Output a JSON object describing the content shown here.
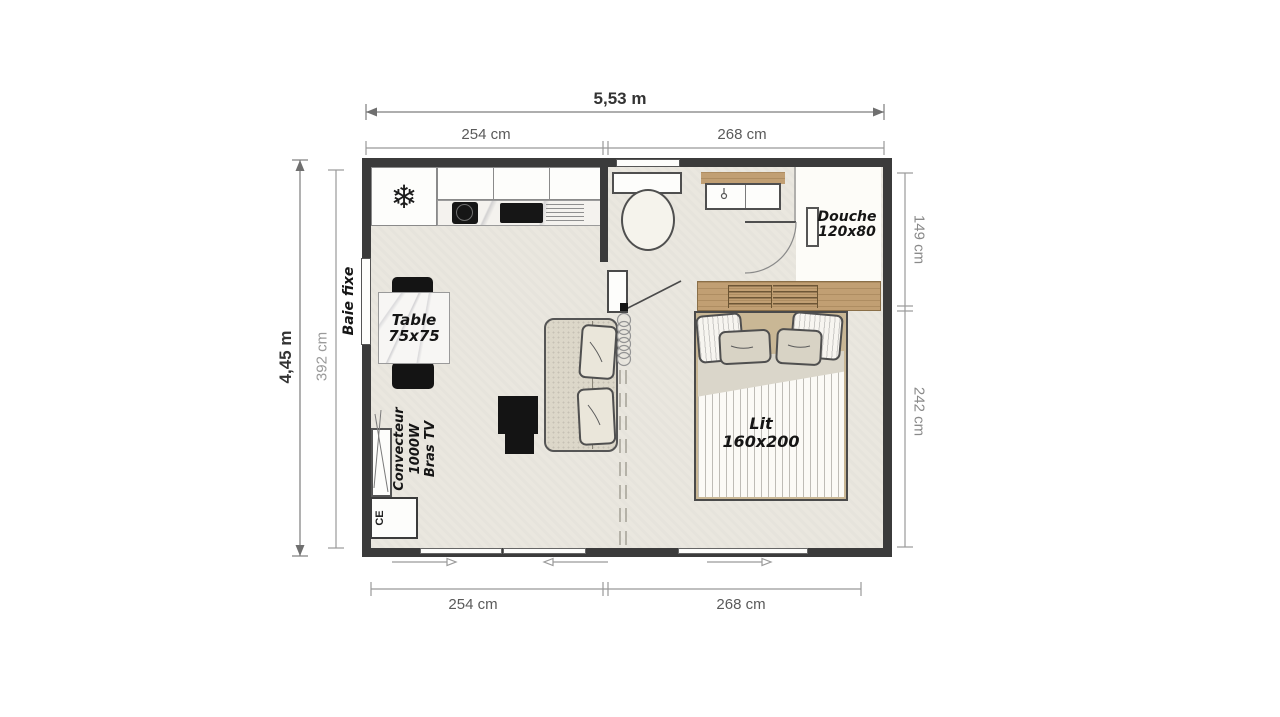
{
  "floorplan": {
    "dimensions": {
      "overall_width": "5,53 m",
      "overall_depth": "4,45 m",
      "interior_depth": "392 cm",
      "top_left_section": "254 cm",
      "top_right_section": "268 cm",
      "bottom_left_section": "254 cm",
      "bottom_right_section": "268 cm",
      "right_top_section": "149 cm",
      "right_bottom_section": "242 cm"
    },
    "labels": {
      "fixed_window": "Baie fixe",
      "table": [
        "Table",
        "75x75"
      ],
      "heater": [
        "Convecteur",
        "1000W",
        "Bras TV"
      ],
      "ce_mark": "CE",
      "shower": [
        "Douche",
        "120x80"
      ],
      "bed": [
        "Lit",
        "160x200"
      ]
    },
    "icons": {
      "fridge_snowflake": "❄"
    },
    "colors": {
      "wall": "#3b3b3b",
      "floor": "#eae7df",
      "wood": "#c19f73",
      "furniture_black": "#141414",
      "dimension_text": "#5a5a5a"
    }
  }
}
